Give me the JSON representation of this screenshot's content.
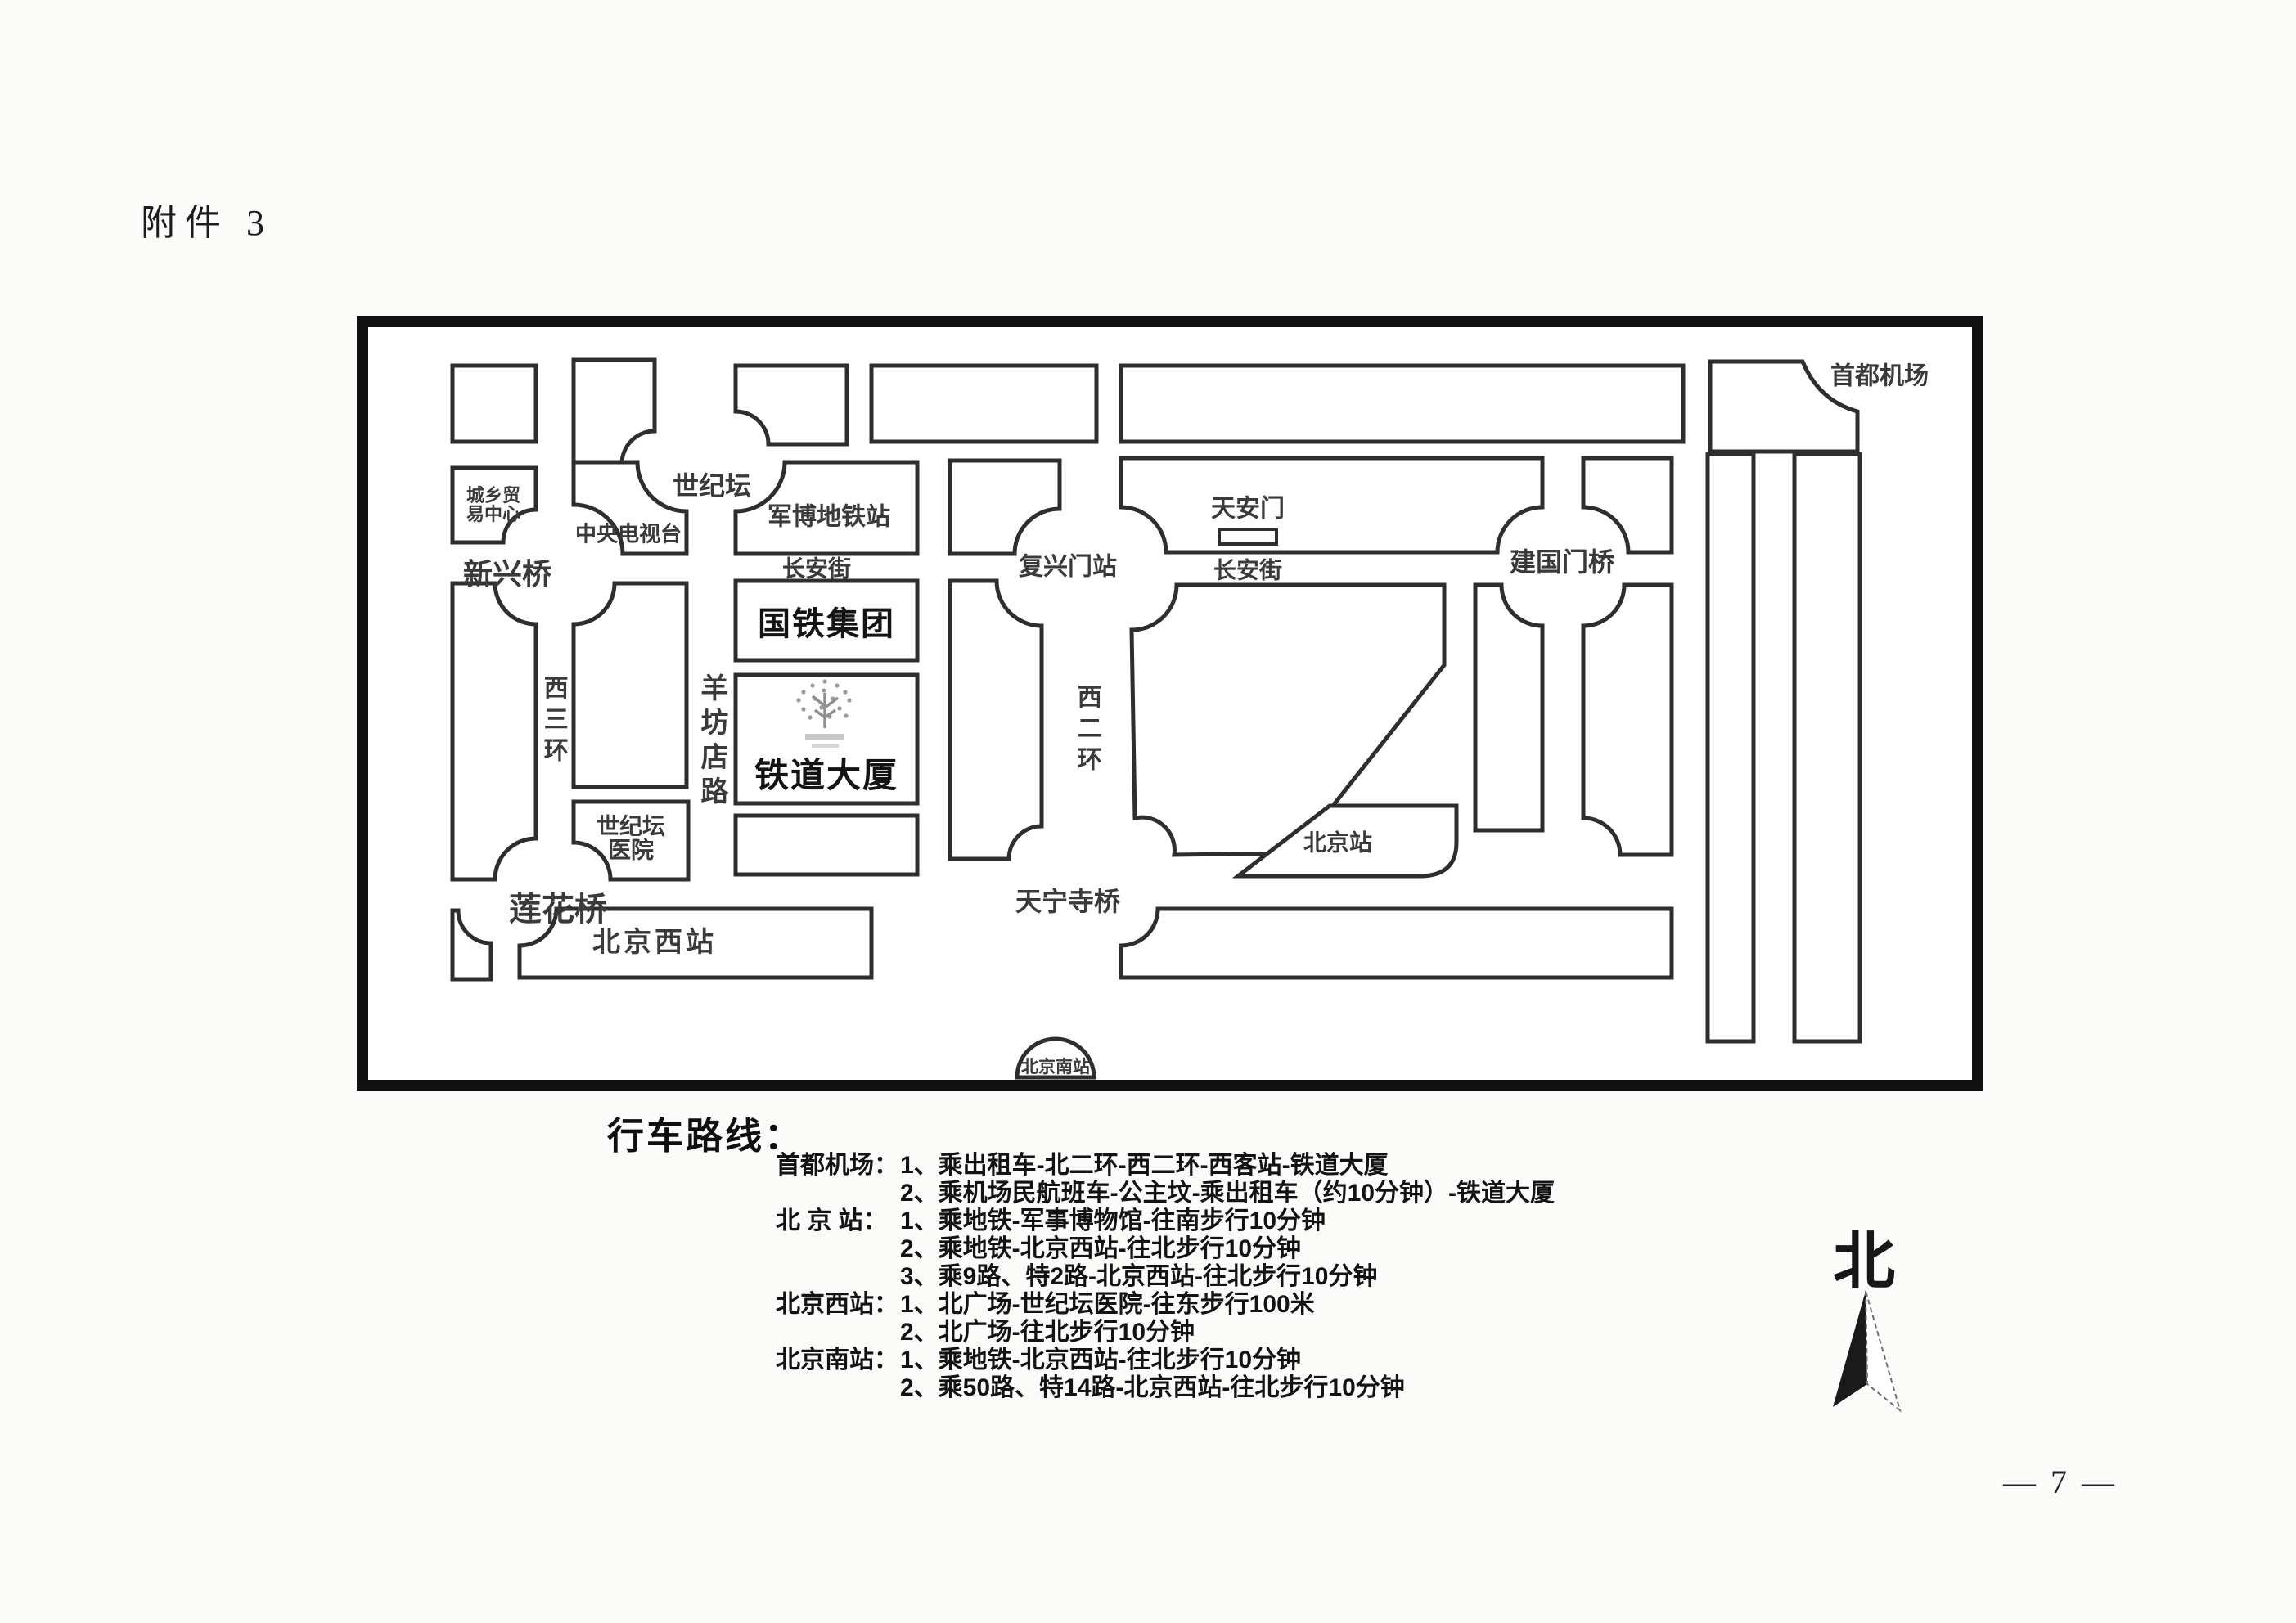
{
  "page": {
    "attachment_label": "附件 3",
    "page_number": "— 7 —"
  },
  "map": {
    "labels": {
      "city_trade_1": "城乡贸",
      "city_trade_2": "易中心",
      "shijitan": "世纪坛",
      "cctv": "中央电视台",
      "junbo_station": "军博地铁站",
      "changan_west": "长安街",
      "changan_east": "长安街",
      "xinxing_bridge": "新兴桥",
      "guotie_group": "国铁集团",
      "xisanhuan": "西三环",
      "yangfangdian_road": "羊坊店路",
      "tiedao_mansion": "铁道大厦",
      "hospital_1": "世纪坛",
      "hospital_2": "医院",
      "lianhua_bridge": "莲花桥",
      "beijing_west_station": "北京西站",
      "fuxingmen_station": "复兴门站",
      "tiananmen": "天安门",
      "xierhuan": "西二环",
      "tianningsi_bridge": "天宁寺桥",
      "beijing_station": "北京站",
      "jianguomen_bridge": "建国门桥",
      "capital_airport": "首都机场",
      "beijing_south_station": "北京南站"
    }
  },
  "routes": {
    "title": "行车路线：",
    "rows": [
      {
        "label": "首都机场：",
        "text": "1、乘出租车-北二环-西二环-西客站-铁道大厦"
      },
      {
        "label": "",
        "text": "2、乘机场民航班车-公主坟-乘出租车（约10分钟）-铁道大厦"
      },
      {
        "label": "北 京 站：",
        "text": "1、乘地铁-军事博物馆-往南步行10分钟"
      },
      {
        "label": "",
        "text": "2、乘地铁-北京西站-往北步行10分钟"
      },
      {
        "label": "",
        "text": "3、乘9路、特2路-北京西站-往北步行10分钟"
      },
      {
        "label": "北京西站：",
        "text": "1、北广场-世纪坛医院-往东步行100米"
      },
      {
        "label": "",
        "text": "2、北广场-往北步行10分钟"
      },
      {
        "label": "北京南站：",
        "text": "1、乘地铁-北京西站-往北步行10分钟"
      },
      {
        "label": "",
        "text": "2、乘50路、特14路-北京西站-往北步行10分钟"
      }
    ]
  },
  "compass": {
    "north": "北"
  }
}
